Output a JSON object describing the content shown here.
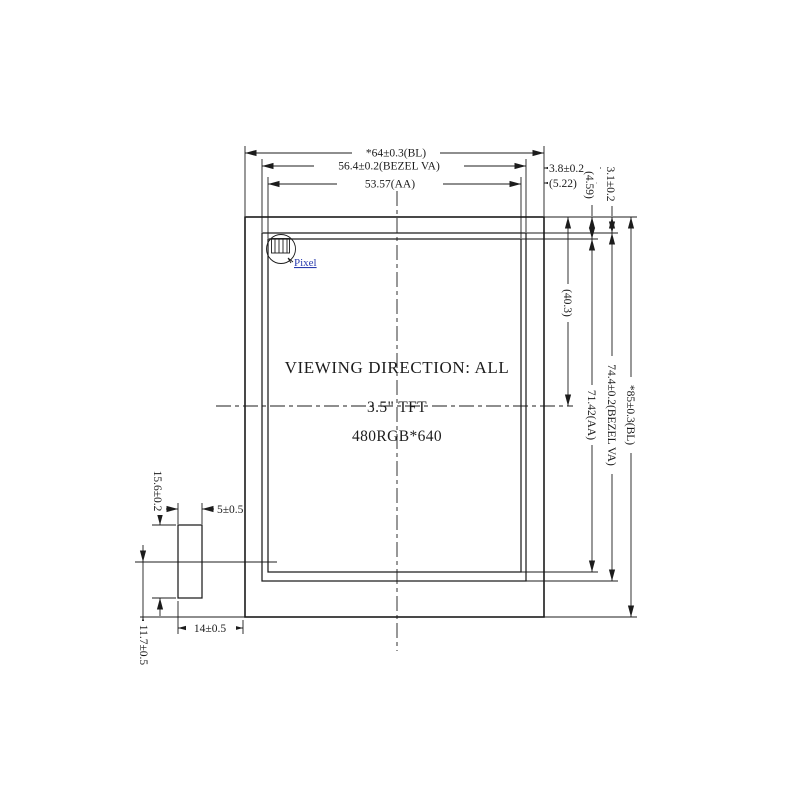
{
  "drawing_labels": {
    "viewing_direction": "VIEWING  DIRECTION: ALL",
    "panel_size": "3.5\" TFT",
    "resolution": "480RGB*640",
    "pixel": "Pixel"
  },
  "dimensions": {
    "bl_width": "*64±0.3(BL)",
    "bezel_va_width": "56.4±0.2(BEZEL VA)",
    "aa_width": "53.57(AA)",
    "bezel_right_margin": "3.8±0.2",
    "aa_right_margin": "(5.22)",
    "aa_top_margin": "(4.59)",
    "bezel_top_margin": "3.1±0.2",
    "center_from_top": "(40.3)",
    "aa_height": "71.42(AA)",
    "bezel_va_height": "74.4±0.2(BEZEL VA)",
    "bl_height": "*85±0.3(BL)",
    "fpc_height": "15.6±0.2",
    "fpc_thickness": "5±0.5",
    "fpc_width": "14±0.5",
    "fpc_bottom_offset": "11.7±0.5"
  },
  "colors": {
    "line": "#1c1c1c",
    "pixel_label": "#2a3cae",
    "background": "#ffffff"
  }
}
